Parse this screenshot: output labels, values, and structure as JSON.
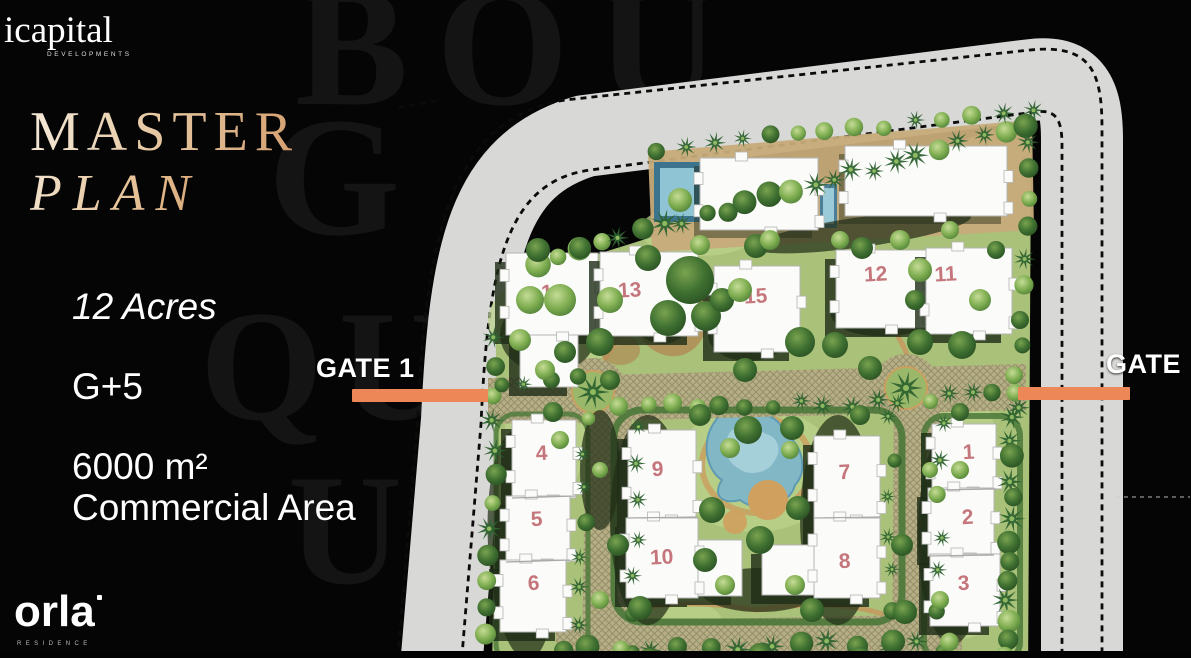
{
  "branding": {
    "developer": "icapital",
    "developer_tagline": "DEVELOPMENTS",
    "residence": "orla",
    "residence_tagline": "RESIDENCE"
  },
  "title": {
    "line1": "MASTER",
    "line2": "PLAN"
  },
  "stats": {
    "acreage": "12 Acres",
    "floors": "G+5",
    "commercial_line1": "6000 m²",
    "commercial_line2": "Commercial Area"
  },
  "gates": [
    {
      "label": "GATE 1",
      "bar": {
        "x": 352,
        "y": 389,
        "w": 136,
        "h": 13
      }
    },
    {
      "label": "GATE",
      "bar": {
        "x": 1018,
        "y": 387,
        "w": 112,
        "h": 13
      }
    }
  ],
  "watermarks": [
    "BOU",
    "G",
    "QUE",
    "U"
  ],
  "colors": {
    "gate_bar": "#ee8757",
    "building_number": "#c4767c",
    "title_gradient": [
      "#f5ead9",
      "#d49e6d"
    ],
    "road_gray": "#d8d8d6",
    "lawn_green": "#a9c178",
    "pond_blue": "#82b7c6"
  },
  "map": {
    "buildings": [
      {
        "n": "14",
        "x": 506,
        "y": 253,
        "w": 92,
        "h": 82,
        "lx": 553,
        "ly": 299,
        "ext": {
          "x": 520,
          "y": 335,
          "w": 58,
          "h": 52
        }
      },
      {
        "n": "13",
        "x": 600,
        "y": 252,
        "w": 98,
        "h": 84,
        "lx": 630,
        "ly": 297
      },
      {
        "n": "15",
        "x": 714,
        "y": 266,
        "w": 86,
        "h": 86,
        "lx": 756,
        "ly": 303
      },
      {
        "n": "12",
        "x": 836,
        "y": 250,
        "w": 90,
        "h": 78,
        "lx": 876,
        "ly": 281
      },
      {
        "n": "11",
        "x": 926,
        "y": 248,
        "w": 86,
        "h": 86,
        "lx": 946,
        "ly": 281
      },
      {
        "n": "4",
        "x": 512,
        "y": 420,
        "w": 64,
        "h": 78,
        "lx": 542,
        "ly": 460
      },
      {
        "n": "5",
        "x": 506,
        "y": 496,
        "w": 64,
        "h": 66,
        "lx": 537,
        "ly": 526
      },
      {
        "n": "6",
        "x": 500,
        "y": 560,
        "w": 66,
        "h": 72,
        "lx": 534,
        "ly": 590
      },
      {
        "n": "9",
        "x": 628,
        "y": 430,
        "w": 68,
        "h": 88,
        "lx": 658,
        "ly": 476
      },
      {
        "n": "10",
        "x": 626,
        "y": 518,
        "w": 72,
        "h": 80,
        "lx": 662,
        "ly": 564,
        "ext": {
          "x": 698,
          "y": 540,
          "w": 44,
          "h": 56
        }
      },
      {
        "n": "7",
        "x": 814,
        "y": 436,
        "w": 66,
        "h": 82,
        "lx": 845,
        "ly": 479
      },
      {
        "n": "8",
        "x": 814,
        "y": 518,
        "w": 66,
        "h": 80,
        "lx": 845,
        "ly": 568,
        "ext": {
          "x": 762,
          "y": 545,
          "w": 52,
          "h": 50
        }
      },
      {
        "n": "1",
        "x": 932,
        "y": 424,
        "w": 64,
        "h": 66,
        "lx": 969,
        "ly": 459
      },
      {
        "n": "2",
        "x": 928,
        "y": 488,
        "w": 66,
        "h": 68,
        "lx": 968,
        "ly": 524
      },
      {
        "n": "3",
        "x": 930,
        "y": 554,
        "w": 70,
        "h": 72,
        "lx": 964,
        "ly": 590
      },
      {
        "n": "",
        "x": 700,
        "y": 158,
        "w": 118,
        "h": 72
      },
      {
        "n": "",
        "x": 845,
        "y": 146,
        "w": 162,
        "h": 70
      }
    ]
  }
}
